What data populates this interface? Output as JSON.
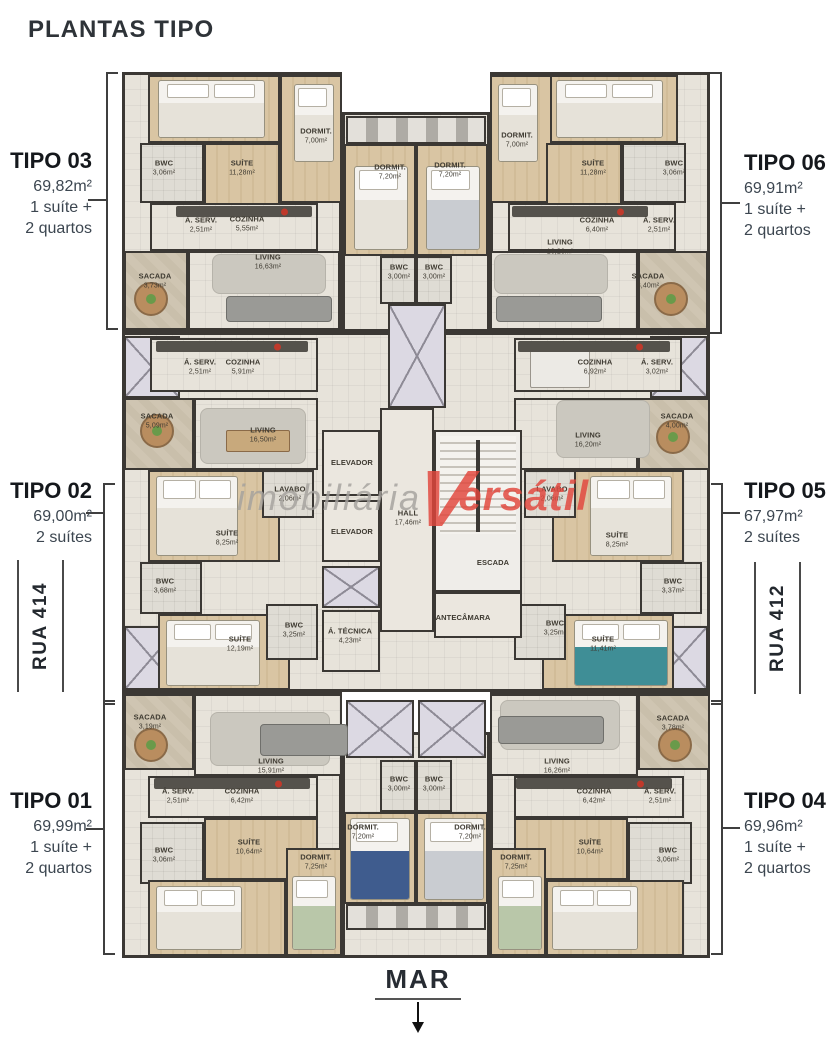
{
  "page": {
    "title": "PLANTAS TIPO",
    "mar_label": "MAR"
  },
  "watermark": {
    "part1": "imobiliária",
    "initial": "V",
    "part2": "ersátil"
  },
  "streets": {
    "left": "RUA 414",
    "right": "RUA 412"
  },
  "apartments": {
    "tipo03": {
      "name": "TIPO 03",
      "area": "69,82m²",
      "line1": "1 suíte +",
      "line2": "2 quartos"
    },
    "tipo02": {
      "name": "TIPO 02",
      "area": "69,00m²",
      "line1": "2 suítes",
      "line2": ""
    },
    "tipo01": {
      "name": "TIPO 01",
      "area": "69,99m²",
      "line1": "1 suíte +",
      "line2": "2 quartos"
    },
    "tipo06": {
      "name": "TIPO 06",
      "area": "69,91m²",
      "line1": "1 suíte +",
      "line2": "2 quartos"
    },
    "tipo05": {
      "name": "TIPO 05",
      "area": "67,97m²",
      "line1": "2 suítes",
      "line2": ""
    },
    "tipo04": {
      "name": "TIPO 04",
      "area": "69,96m²",
      "line1": "1 suíte +",
      "line2": "2 quartos"
    }
  },
  "rooms": {
    "t03": [
      {
        "n": "DORMIT.",
        "a": "7,00m²"
      },
      {
        "n": "BWC",
        "a": "3,06m²"
      },
      {
        "n": "SUÍTE",
        "a": "11,28m²"
      },
      {
        "n": "Á. SERV.",
        "a": "2,51m²"
      },
      {
        "n": "COZINHA",
        "a": "5,55m²"
      },
      {
        "n": "LIVING",
        "a": "16,63m²"
      },
      {
        "n": "SACADA",
        "a": "3,73m²"
      }
    ],
    "ct": [
      {
        "n": "DORMIT.",
        "a": "7,20m²"
      },
      {
        "n": "DORMIT.",
        "a": "7,20m²"
      },
      {
        "n": "BWC",
        "a": "3,00m²"
      },
      {
        "n": "BWC",
        "a": "3,00m²"
      }
    ],
    "t06": [
      {
        "n": "DORMIT.",
        "a": "7,00m²"
      },
      {
        "n": "SUÍTE",
        "a": "11,28m²"
      },
      {
        "n": "BWC",
        "a": "3,06m²"
      },
      {
        "n": "COZINHA",
        "a": "6,40m²"
      },
      {
        "n": "Á. SERV.",
        "a": "2,51m²"
      },
      {
        "n": "LIVING",
        "a": "16,26m²"
      },
      {
        "n": "SACADA",
        "a": "3,40m²"
      }
    ],
    "t02": [
      {
        "n": "Á. SERV.",
        "a": "2,51m²"
      },
      {
        "n": "COZINHA",
        "a": "5,91m²"
      },
      {
        "n": "SACADA",
        "a": "5,09m²"
      },
      {
        "n": "LIVING",
        "a": "16,50m²"
      },
      {
        "n": "SUÍTE",
        "a": "8,25m²"
      },
      {
        "n": "BWC",
        "a": "3,68m²"
      },
      {
        "n": "SUÍTE",
        "a": "12,19m²"
      },
      {
        "n": "BWC",
        "a": "3,25m²"
      }
    ],
    "t05": [
      {
        "n": "COZINHA",
        "a": "6,92m²"
      },
      {
        "n": "Á. SERV.",
        "a": "3,02m²"
      },
      {
        "n": "SACADA",
        "a": "4,00m²"
      },
      {
        "n": "LIVING",
        "a": "16,20m²"
      },
      {
        "n": "SUÍTE",
        "a": "8,25m²"
      },
      {
        "n": "BWC",
        "a": "3,37m²"
      },
      {
        "n": "SUÍTE",
        "a": "11,41m²"
      },
      {
        "n": "BWC",
        "a": "3,25m²"
      }
    ],
    "core": [
      {
        "n": "ELEVADOR",
        "a": ""
      },
      {
        "n": "ELEVADOR",
        "a": ""
      },
      {
        "n": "LAVABO",
        "a": "2,06m²"
      },
      {
        "n": "LAVABO",
        "a": "2,06m²"
      },
      {
        "n": "HALL",
        "a": "17,46m²"
      },
      {
        "n": "ESCADA",
        "a": ""
      },
      {
        "n": "ANTECÂMARA",
        "a": ""
      },
      {
        "n": "Á. TÉCNICA",
        "a": "4,23m²"
      }
    ],
    "t01": [
      {
        "n": "SACADA",
        "a": "3,19m²"
      },
      {
        "n": "LIVING",
        "a": "15,91m²"
      },
      {
        "n": "Á. SERV.",
        "a": "2,51m²"
      },
      {
        "n": "COZINHA",
        "a": "6,42m²"
      },
      {
        "n": "SUÍTE",
        "a": "10,64m²"
      },
      {
        "n": "BWC",
        "a": "3,06m²"
      },
      {
        "n": "DORMIT.",
        "a": "7,25m²"
      }
    ],
    "cb": [
      {
        "n": "BWC",
        "a": "3,00m²"
      },
      {
        "n": "BWC",
        "a": "3,00m²"
      },
      {
        "n": "DORMIT.",
        "a": "7,20m²"
      },
      {
        "n": "DORMIT.",
        "a": "7,20m²"
      }
    ],
    "t04": [
      {
        "n": "SACADA",
        "a": "3,78m²"
      },
      {
        "n": "LIVING",
        "a": "16,26m²"
      },
      {
        "n": "COZINHA",
        "a": "6,42m²"
      },
      {
        "n": "Á. SERV.",
        "a": "2,51m²"
      },
      {
        "n": "SUÍTE",
        "a": "10,64m²"
      },
      {
        "n": "BWC",
        "a": "3,06m²"
      },
      {
        "n": "DORMIT.",
        "a": "7,25m²"
      }
    ]
  }
}
